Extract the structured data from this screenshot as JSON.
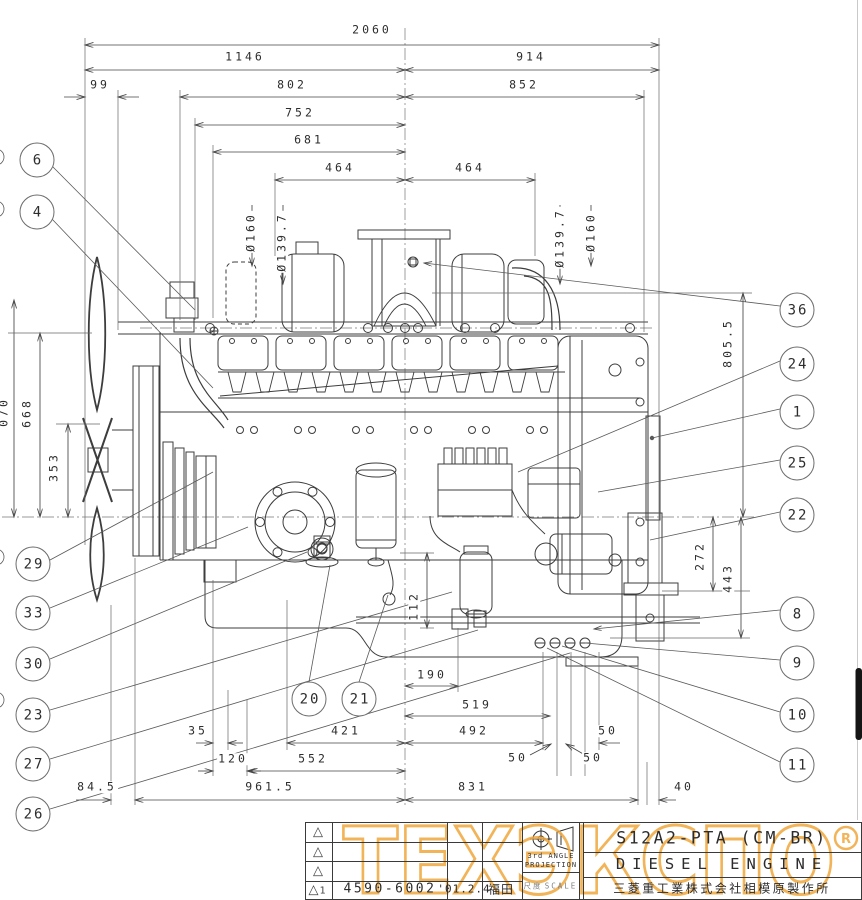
{
  "title_block": {
    "model": "S12A2-PTA (CM-BR)",
    "product": "DIESEL ENGINE",
    "company": "三菱重工業株式会社相模原製作所",
    "drawing_no": "4590-6002",
    "date": "'01.2.4",
    "name_stamp": "福田",
    "projection_line1": "3rd ANGLE",
    "projection_line2": "PROJECTION",
    "scale_kanji": "尺度",
    "scale_en": "SCALE",
    "revision_no": "1",
    "revision_triangle": "△"
  },
  "watermark": {
    "text": "ТЕХЭКСПО",
    "registered": "R",
    "color": "#F0A73C"
  },
  "dims": {
    "d2060": "2060",
    "d1146": "1146",
    "d914": "914",
    "d99": "99",
    "d802": "802",
    "d852": "852",
    "d752": "752",
    "d681": "681",
    "d464L": "464",
    "d464R": "464",
    "dia160L": "Ø160",
    "dia1397L": "Ø139.7",
    "dia1397R": "Ø139.7",
    "dia160R": "Ø160",
    "d070": "070",
    "d668": "668",
    "d353": "353",
    "d8055": "805.5",
    "d272": "272",
    "d443": "443",
    "d112": "112",
    "d190": "190",
    "d519": "519",
    "d421": "421",
    "d492": "492",
    "d50a": "50",
    "d35": "35",
    "d120": "120",
    "d552": "552",
    "d50b": "50",
    "d50c": "50",
    "d845": "84.5",
    "d9615": "961.5",
    "d831": "831",
    "d40": "40"
  },
  "balloons": {
    "b6": "6",
    "b4": "4",
    "b29": "29",
    "b33": "33",
    "b30": "30",
    "b23": "23",
    "b27": "27",
    "b26": "26",
    "b20": "20",
    "b21": "21",
    "b36": "36",
    "b24": "24",
    "b1": "1",
    "b25": "25",
    "b22": "22",
    "b8": "8",
    "b9": "9",
    "b10": "10",
    "b11": "11"
  }
}
